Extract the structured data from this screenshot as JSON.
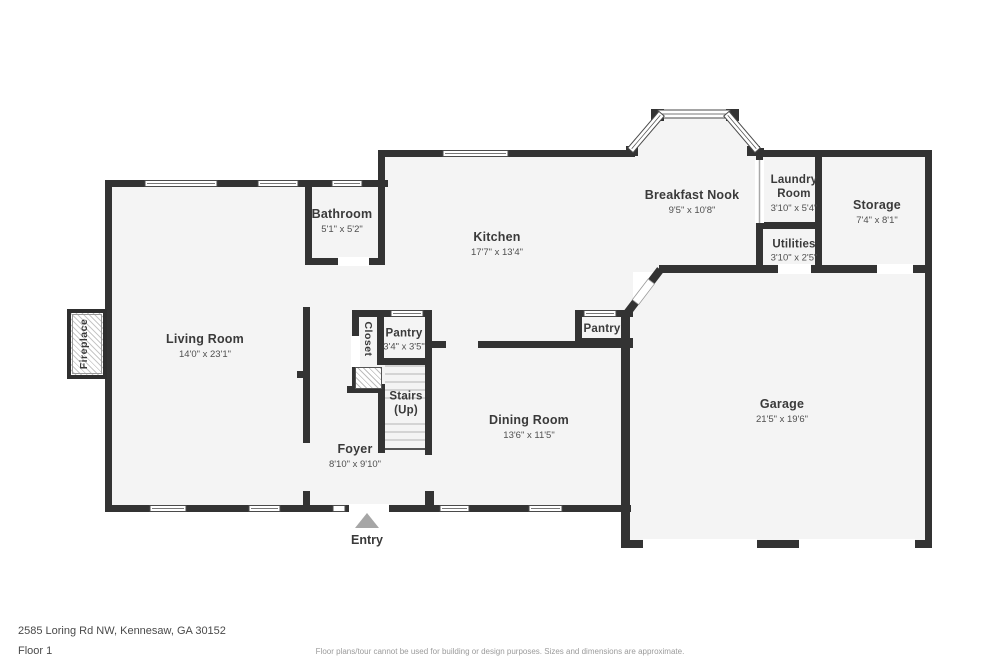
{
  "plan": {
    "rooms": {
      "living": {
        "name": "Living Room",
        "dims": "14'0\" x 23'1\""
      },
      "bathroom": {
        "name": "Bathroom",
        "dims": "5'1\" x 5'2\""
      },
      "kitchen": {
        "name": "Kitchen",
        "dims": "17'7\" x 13'4\""
      },
      "breakfast_nook": {
        "name": "Breakfast Nook",
        "dims": "9'5\" x 10'8\""
      },
      "laundry": {
        "name": "Laundry Room",
        "dims": "3'10\" x 5'4\""
      },
      "storage": {
        "name": "Storage",
        "dims": "7'4\" x 8'1\""
      },
      "utilities": {
        "name": "Utilities",
        "dims": "3'10\" x 2'5\""
      },
      "pantry_small": {
        "name": "Pantry",
        "dims": "3'4\" x 3'5\""
      },
      "pantry_garage": {
        "name": "Pantry"
      },
      "closet": {
        "name": "Closet"
      },
      "stairs": {
        "name": "Stairs",
        "sub": "(Up)"
      },
      "foyer": {
        "name": "Foyer",
        "dims": "8'10\" x 9'10\""
      },
      "dining": {
        "name": "Dining Room",
        "dims": "13'6\" x 11'5\""
      },
      "garage": {
        "name": "Garage",
        "dims": "21'5\" x 19'6\""
      },
      "fireplace": {
        "name": "Fireplace"
      },
      "entry": {
        "name": "Entry"
      }
    },
    "colors": {
      "wall": "#333333",
      "room_fill": "#f4f4f4",
      "label_text": "#3a3a3a",
      "entry_arrow": "#a6a6a6"
    }
  },
  "footer": {
    "address": "2585 Loring Rd NW, Kennesaw, GA 30152",
    "floor": "Floor 1",
    "disclaimer": "Floor plans/tour cannot be used for building or design purposes. Sizes and dimensions are approximate."
  }
}
